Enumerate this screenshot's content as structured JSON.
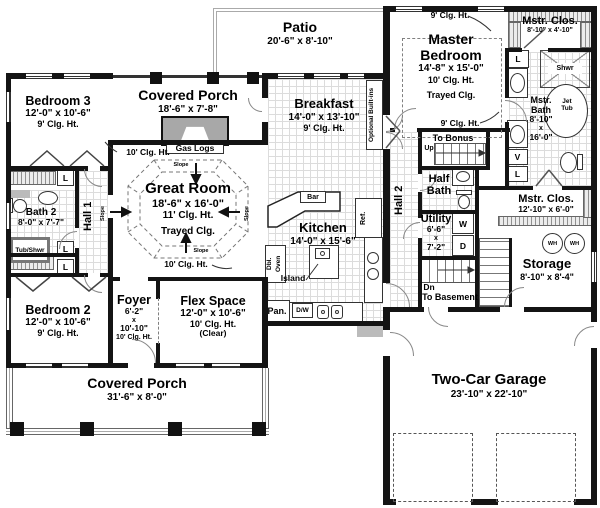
{
  "rooms": {
    "patio": {
      "name": "Patio",
      "dims": "20'-6\" x 8'-10\""
    },
    "porch_top": {
      "name": "Covered Porch",
      "dims": "18'-6\" x 7'-8\""
    },
    "bedroom3": {
      "name": "Bedroom 3",
      "dims": "12'-0\" x 10'-6\"",
      "clg": "9' Clg. Ht."
    },
    "breakfast": {
      "name": "Breakfast",
      "dims": "14'-0\" x 13'-10\"",
      "clg": "9' Clg. Ht."
    },
    "master": {
      "name1": "Master",
      "name2": "Bedroom",
      "dims": "14'-8\" x 15'-0\"",
      "clg": "10' Clg. Ht.",
      "tray": "Trayed Clg."
    },
    "mstr_clos_top": {
      "name": "Mstr. Clos.",
      "dims": "8'-10\" x 4'-10\""
    },
    "mstr_bath": {
      "name1": "Mstr.",
      "name2": "Bath",
      "d1": "8'-10\"",
      "d2": "x",
      "d3": "16'-0\""
    },
    "great_room": {
      "name": "Great Room",
      "dims": "18'-6\" x 16'-0\"",
      "clg": "11' Clg. Ht.",
      "tray": "Trayed Clg."
    },
    "kitchen": {
      "name": "Kitchen",
      "dims": "14'-0\" x 15'-6\""
    },
    "bath2": {
      "name": "Bath 2",
      "dims": "8'-0\" x 7'-7\""
    },
    "hall1": {
      "name": "Hall 1"
    },
    "hall2": {
      "name": "Hall 2"
    },
    "half_bath": {
      "name1": "Half",
      "name2": "Bath"
    },
    "utility": {
      "name": "Utility",
      "d1": "6'-6\"",
      "d2": "x",
      "d3": "7'-2\""
    },
    "mstr_clos_bot": {
      "name": "Mstr. Clos.",
      "dims": "12'-10\" x 6'-0\""
    },
    "storage": {
      "name": "Storage",
      "dims": "8'-10\" x 8'-4\""
    },
    "bedroom2": {
      "name": "Bedroom 2",
      "dims": "12'-0\" x 10'-6\"",
      "clg": "9' Clg. Ht."
    },
    "foyer": {
      "name": "Foyer",
      "d1": "6'-2\"",
      "d2": "x",
      "d3": "10'-10\"",
      "clg": "10' Clg. Ht."
    },
    "flex": {
      "name": "Flex Space",
      "dims": "12'-0\" x 10'-6\"",
      "clg": "10' Clg. Ht.",
      "note": "(Clear)"
    },
    "porch_bottom": {
      "name": "Covered Porch",
      "dims": "31'-6\" x 8'-0\""
    },
    "garage": {
      "name": "Two-Car Garage",
      "dims": "23'-10\" x 22'-10\""
    }
  },
  "labels": {
    "gas_logs": "Gas Logs",
    "optional_builtins": "Optional Built-ins",
    "bar": "Bar",
    "ref": "Ref.",
    "dbl": "Dbl.",
    "oven": "Oven",
    "island": "Island",
    "pan": "Pan.",
    "dw": "D/W",
    "tub_shwr": "Tub/Shwr",
    "shwr": "Shwr",
    "jet": "Jet",
    "tub": "Tub",
    "l": "L",
    "v": "V",
    "w": "W",
    "d": "D",
    "wh": "WH",
    "up": "Up",
    "dn": "Dn",
    "to_bonus": "To Bonus",
    "to_basement": "To Basement",
    "slope": "Slope",
    "clg_9": "9' Clg. Ht.",
    "clg_10": "10' Clg. Ht."
  },
  "colors": {
    "wall": "#141414",
    "tile_line": "#dcdcdc",
    "hatch": "#909090",
    "dash": "#808080"
  }
}
